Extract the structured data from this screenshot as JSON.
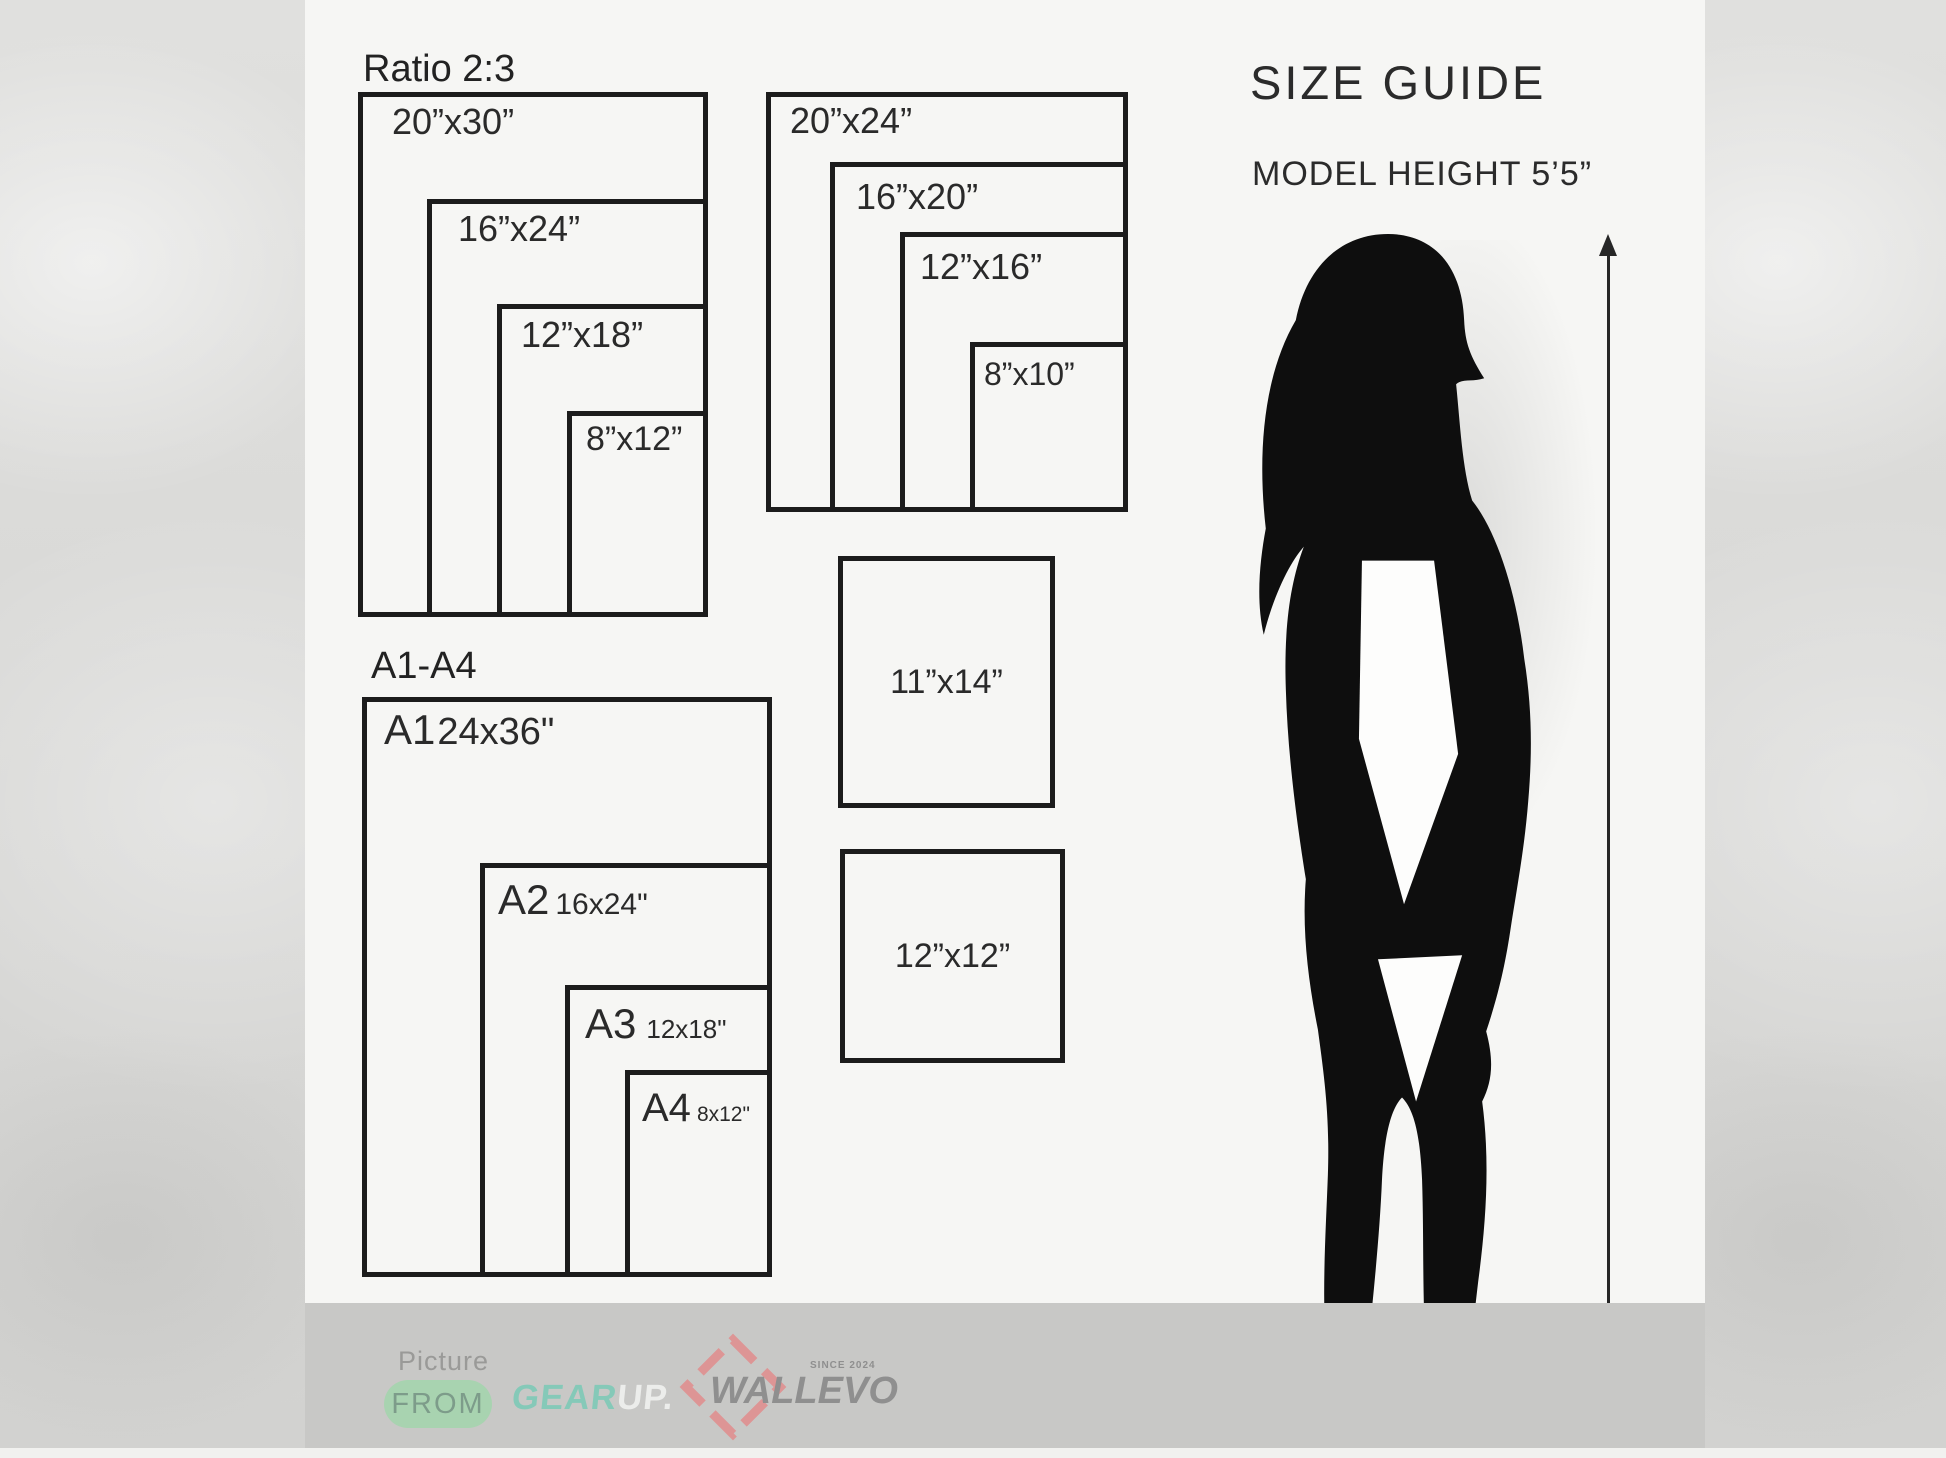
{
  "page_title": "Size Guide",
  "ratio_group": {
    "title": "Ratio 2:3",
    "sizes": [
      {
        "label": "20”x30”"
      },
      {
        "label": "16”x24”"
      },
      {
        "label": "12”x18”"
      },
      {
        "label": "8”x12”"
      }
    ]
  },
  "standard_group": {
    "sizes": [
      {
        "label": "20”x24”"
      },
      {
        "label": "16”x20”"
      },
      {
        "label": "12”x16”"
      },
      {
        "label": "8”x10”"
      }
    ]
  },
  "single_sizes": [
    {
      "label": "11”x14”"
    },
    {
      "label": "12”x12”"
    }
  ],
  "a_series_group": {
    "title": "A1-A4",
    "sizes": [
      {
        "code": "A1",
        "dims": "24x36\""
      },
      {
        "code": "A2",
        "dims": "16x24\""
      },
      {
        "code": "A3",
        "dims": "12x18\""
      },
      {
        "code": "A4",
        "dims": "8x12\""
      }
    ]
  },
  "size_guide": {
    "title": "SIZE GUIDE",
    "model_height": "MODEL HEIGHT 5’5”"
  },
  "footer": {
    "picture_label": "Picture",
    "from_label": "FROM",
    "gear": "GEAR",
    "up": "UP.",
    "brand": "WALLEVO",
    "since": "SINCE 2024"
  },
  "colors": {
    "panel": "#f6f6f4",
    "side_texture": "#d8d8d6",
    "footer_band": "#c8c8c6",
    "outline": "#1c1c1c",
    "silhouette": "#0e0e0e",
    "from_pill_green": "#a8d3b0",
    "gear_teal": "#85c9b8",
    "up_white": "#ecedeb",
    "wallevo_red": "#dd9595",
    "logo_gray": "#8f8f8f"
  }
}
